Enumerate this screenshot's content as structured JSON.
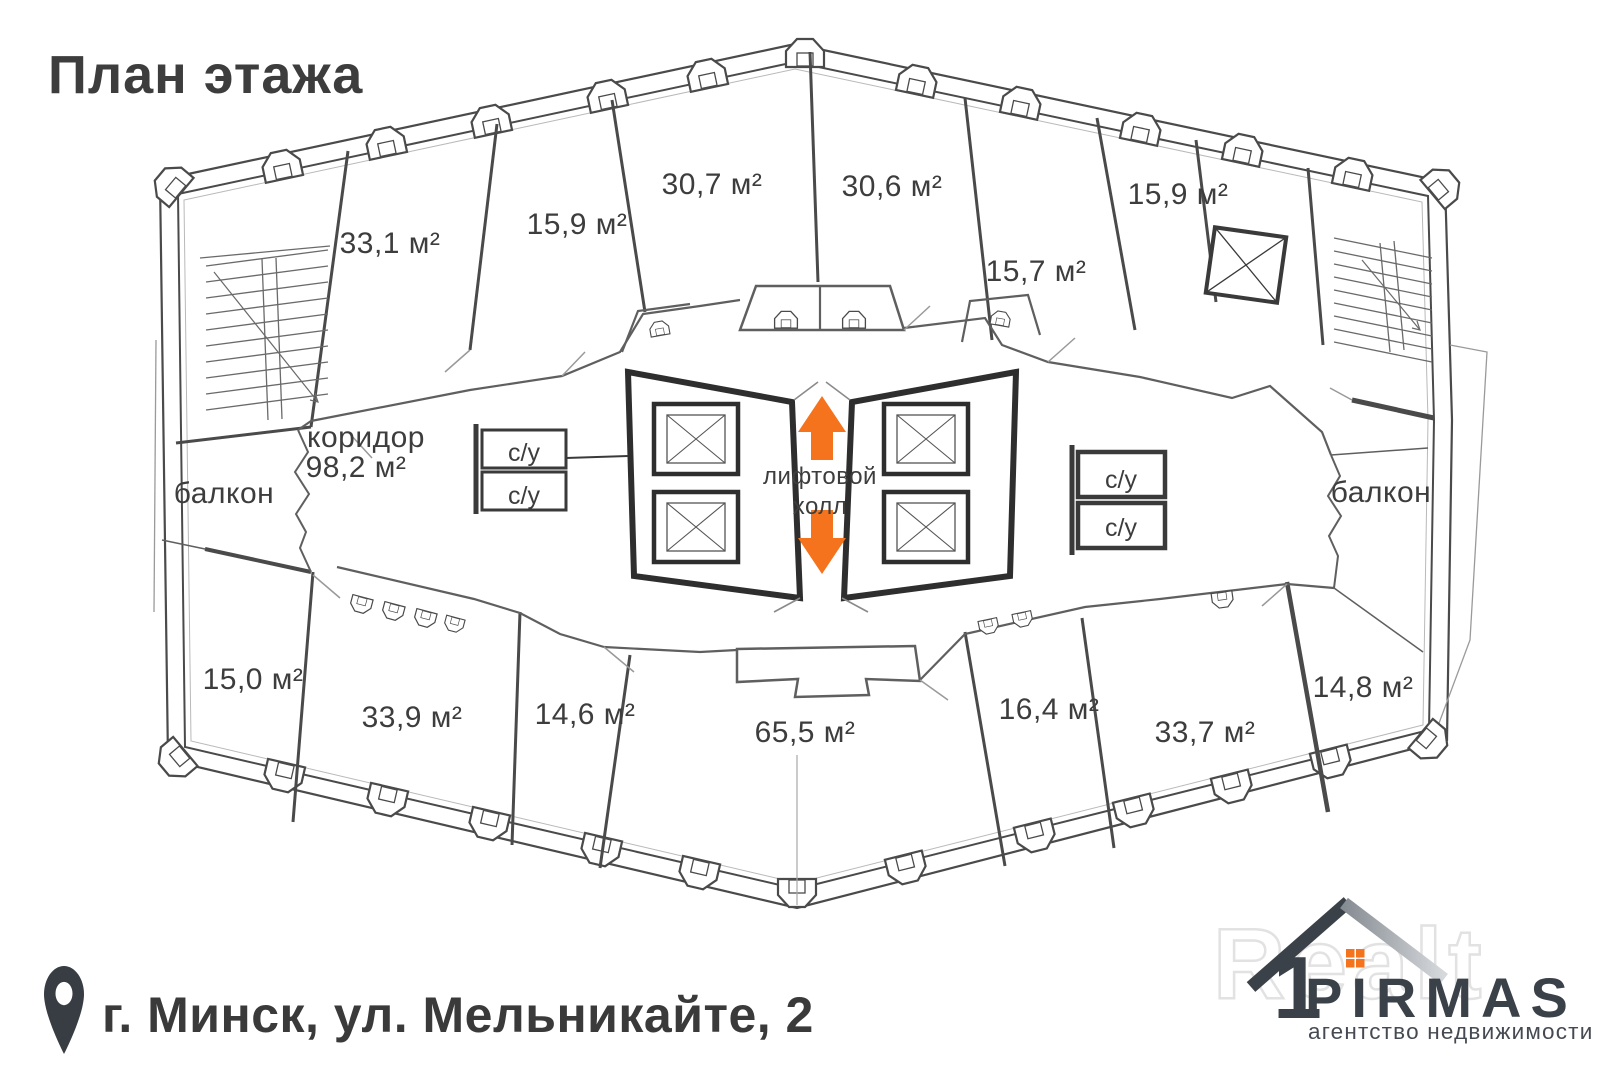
{
  "page": {
    "title": "План этажа",
    "background": "#ffffff"
  },
  "colors": {
    "accent_orange": "#f4731c",
    "line_dark": "#2e2e2e",
    "line": "#4a4a4a",
    "text": "#3d3d3d",
    "logo_dark": "#3b4148",
    "watermark": "#e7e7e7"
  },
  "floor_plan": {
    "rooms": [
      {
        "id": "33-1",
        "area_label": "33,1 м²"
      },
      {
        "id": "15-9-left",
        "area_label": "15,9 м²"
      },
      {
        "id": "30-7",
        "area_label": "30,7 м²"
      },
      {
        "id": "30-6",
        "area_label": "30,6 м²"
      },
      {
        "id": "15-7",
        "area_label": "15,7 м²"
      },
      {
        "id": "15-9-right",
        "area_label": "15,9 м²"
      },
      {
        "id": "15-0",
        "area_label": "15,0 м²"
      },
      {
        "id": "33-9",
        "area_label": "33,9 м²"
      },
      {
        "id": "14-6",
        "area_label": "14,6 м²"
      },
      {
        "id": "65-5",
        "area_label": "65,5 м²"
      },
      {
        "id": "16-4",
        "area_label": "16,4 м²"
      },
      {
        "id": "33-7",
        "area_label": "33,7 м²"
      },
      {
        "id": "14-8",
        "area_label": "14,8 м²"
      }
    ],
    "corridor": {
      "name": "коридор",
      "area_label": "98,2 м²"
    },
    "balcony_left": "балкон",
    "balcony_right": "балкон",
    "elevator_hall": {
      "line1": "лифтовой",
      "line2": "холл"
    },
    "bathrooms": [
      "с/у",
      "с/у",
      "с/у",
      "с/у"
    ]
  },
  "footer": {
    "address": "г. Минск, ул. Мельникайте, 2"
  },
  "logo": {
    "brand": "PIRMAS",
    "tagline": "агентство недвижимости",
    "watermark": "Realt"
  }
}
